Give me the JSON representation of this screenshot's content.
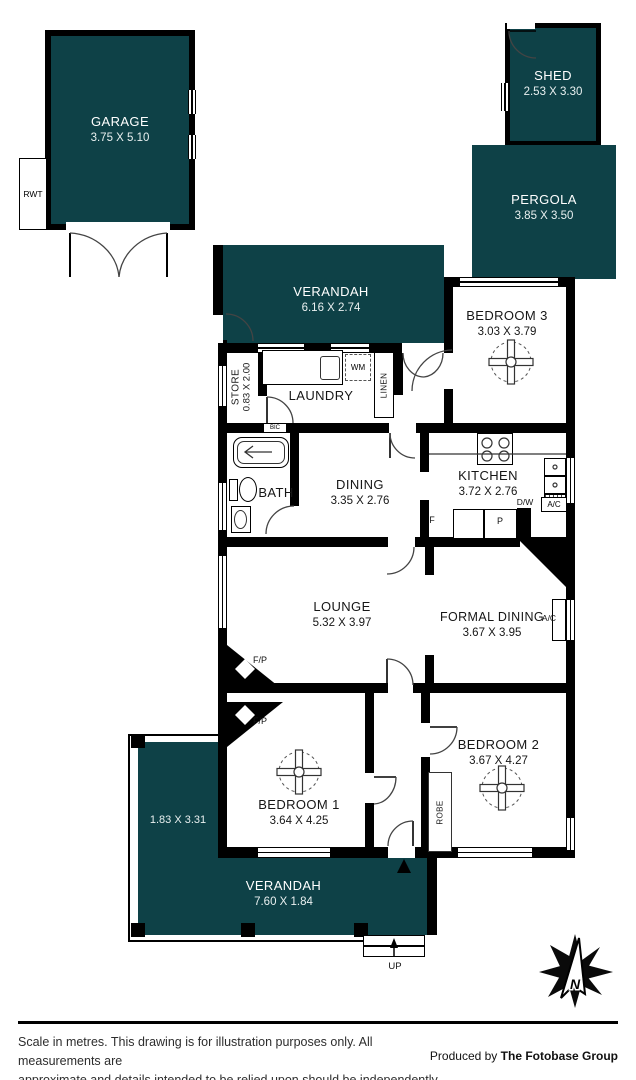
{
  "colors": {
    "teal": "#0E4147",
    "wall": "#000000",
    "paper": "#FFFFFF"
  },
  "outbuildings": {
    "garage": {
      "name": "GARAGE",
      "dims": "3.75 X 5.10"
    },
    "rwt": {
      "label": "RWT"
    },
    "shed": {
      "name": "SHED",
      "dims": "2.53 X 3.30"
    },
    "pergola": {
      "name": "PERGOLA",
      "dims": "3.85 X 3.50"
    }
  },
  "rooms": {
    "verandah_top": {
      "name": "VERANDAH",
      "dims": "6.16 X 2.74"
    },
    "bedroom3": {
      "name": "BEDROOM 3",
      "dims": "3.03 X 3.79"
    },
    "store": {
      "name": "STORE",
      "dims": "0.83 X 2.00"
    },
    "laundry": {
      "name": "LAUNDRY"
    },
    "bath": {
      "name": "BATH"
    },
    "dining": {
      "name": "DINING",
      "dims": "3.35 X 2.76"
    },
    "kitchen": {
      "name": "KITCHEN",
      "dims": "3.72 X 2.76"
    },
    "lounge": {
      "name": "LOUNGE",
      "dims": "5.32 X 3.97"
    },
    "formal_dining": {
      "name": "FORMAL DINING",
      "dims": "3.67 X 3.95"
    },
    "bedroom1": {
      "name": "BEDROOM 1",
      "dims": "3.64 X 4.25"
    },
    "bedroom2": {
      "name": "BEDROOM 2",
      "dims": "3.67 X 4.27"
    },
    "verandah_side": {
      "dims": "1.83 X 3.31"
    },
    "verandah_bottom": {
      "name": "VERANDAH",
      "dims": "7.60 X 1.84"
    }
  },
  "fixtures": {
    "wm": "WM",
    "linen": "LINEN",
    "bic": "BIC",
    "dw": "D/W",
    "ac": "A/C",
    "fridge": "F",
    "pantry": "P",
    "fireplace": "F/P",
    "robe": "ROBE",
    "up": "UP"
  },
  "compass": {
    "north": "N"
  },
  "footer": {
    "disclaimer_line1": "Scale in metres. This drawing is for illustration purposes only. All measurements are",
    "disclaimer_line2": "approximate and details intended to be relied upon should be independently verified.",
    "produced_by": "Produced by",
    "company": "The Fotobase Group"
  }
}
